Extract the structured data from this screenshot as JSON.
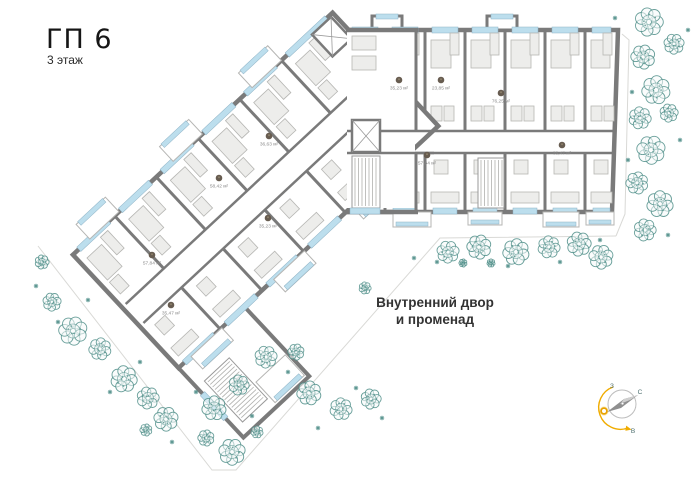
{
  "title": {
    "main": "ГП 6",
    "subtitle": "3 этаж"
  },
  "courtyard": {
    "line1": "Внутренний двор",
    "line2": "и променад"
  },
  "compass": {
    "west": "З",
    "north": "С",
    "east": "В"
  },
  "area_badges": [
    {
      "x": 399,
      "y": 80,
      "area": "35,23 м²"
    },
    {
      "x": 441,
      "y": 80,
      "area": "23,85 м²"
    },
    {
      "x": 501,
      "y": 93,
      "area": "76,25 м²"
    },
    {
      "x": 427,
      "y": 155,
      "area": "57,84 м²"
    },
    {
      "x": 562,
      "y": 145,
      "area": "35,47 м²"
    },
    {
      "x": 269,
      "y": 136,
      "area": "36,63 м²"
    },
    {
      "x": 219,
      "y": 178,
      "area": "58,42 м²"
    },
    {
      "x": 268,
      "y": 218,
      "area": "35,23 м²"
    },
    {
      "x": 152,
      "y": 255,
      "area": "57,84 м²"
    },
    {
      "x": 171,
      "y": 305,
      "area": "35,47 м²"
    }
  ],
  "colors": {
    "wall": "#7a7a7a",
    "window": "#bcdeed",
    "window_frame": "#8fb3c6",
    "furniture_fill": "#ededeb",
    "furniture_stroke": "#b6b6b3",
    "tree": "#4f8e88",
    "terrace": "#d9d9d6",
    "sun": "#f0ac00",
    "badge": "#675c50",
    "title_text": "#161616",
    "label_text": "#8a8a8a",
    "courtyard_text": "#333333",
    "compass_letter": "#4d6f6f",
    "needle_dark": "#8f8f8f",
    "needle_light": "#cfcfcf"
  }
}
